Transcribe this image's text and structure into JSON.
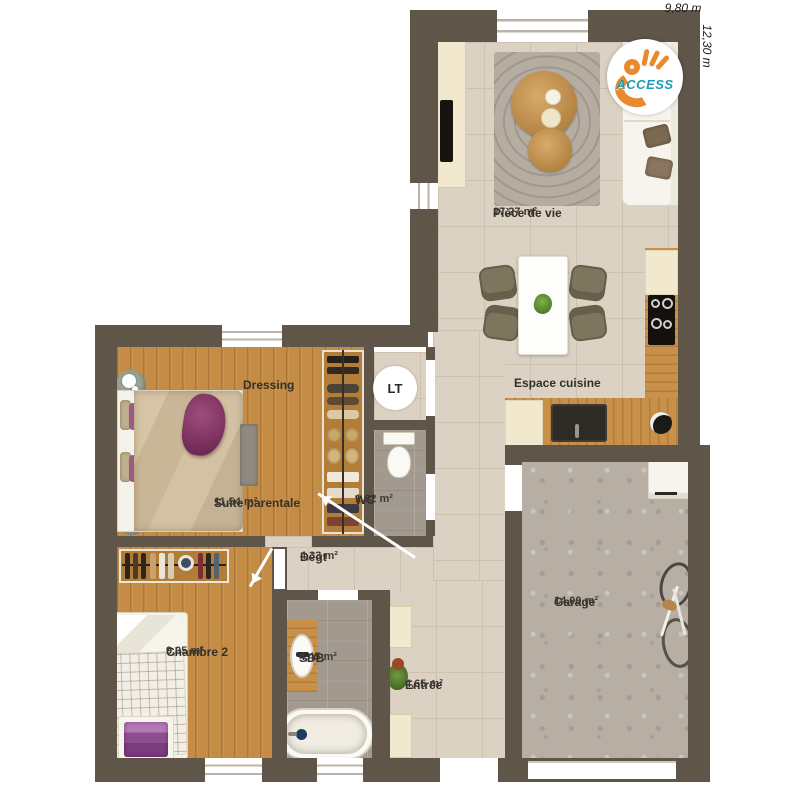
{
  "plan": {
    "dimensions": {
      "width": "9,80 m",
      "depth": "12,30 m"
    },
    "logo_text": "ACCESS",
    "lt_label": "LT"
  },
  "rooms": {
    "piece_de_vie": {
      "name": "Pièce de vie",
      "area": "27,27 m²"
    },
    "espace_cuisine": {
      "name": "Espace cuisine"
    },
    "dressing": {
      "name": "Dressing"
    },
    "suite_parentale": {
      "name": "Suite parentale",
      "area": "11,54 m²"
    },
    "wc": {
      "name": "WC",
      "area": "1,62 m²"
    },
    "degagement": {
      "name": "Dégt",
      "area": "4,33 m²"
    },
    "chambre_2": {
      "name": "Chambre 2",
      "area": "9,05 m²"
    },
    "sdb": {
      "name": "SDB",
      "area": "4,45 m²"
    },
    "entree": {
      "name": "Entrée",
      "area": "4,65 m²"
    },
    "garage": {
      "name": "Garage",
      "area": "14,00 m²"
    }
  },
  "colors": {
    "wall": "#5f5549",
    "tile": "#dcd2c3",
    "tileline": "#cdc1af",
    "wood": "#c58c45",
    "graytile": "#a39a8f",
    "concrete": "#b7aea4",
    "cream": "#f2e8cd",
    "olive": "#7d755d",
    "purple": "#8e3a6b",
    "orange": "#ea8a2e",
    "teal": "#1e9cb4",
    "textdark": "#33302a"
  }
}
